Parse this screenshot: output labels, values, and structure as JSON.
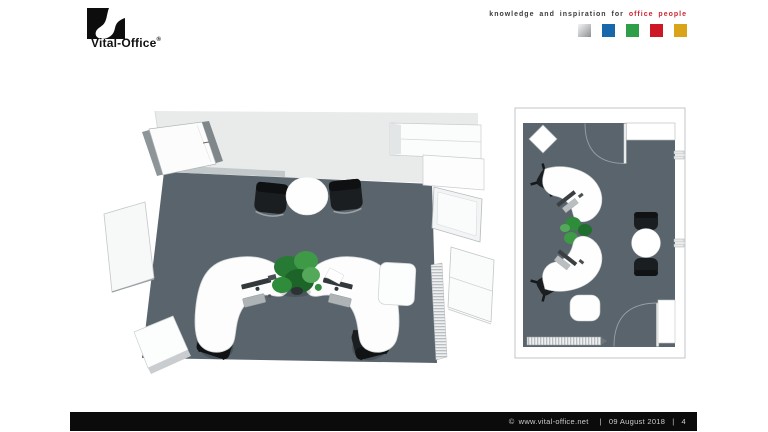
{
  "header": {
    "logo": {
      "text": "Vital-Office",
      "registered_mark": "®"
    },
    "tagline": {
      "prefix": "knowledge and inspiration for",
      "highlight": "office people"
    },
    "brand_squares": [
      {
        "name": "silver",
        "color": "#b5b7b9"
      },
      {
        "name": "blue",
        "color": "#1767ab"
      },
      {
        "name": "green",
        "color": "#2f9e49"
      },
      {
        "name": "red",
        "color": "#cd1626"
      },
      {
        "name": "gold",
        "color": "#d9a417"
      }
    ]
  },
  "content": {
    "perspective_view": {
      "description": "3D bird's-eye rendering of a two-person office",
      "objects": [
        "two curved white workstation desks",
        "two black task chairs",
        "round white meeting table",
        "two black cantilever chairs",
        "green plant",
        "entrance door",
        "wardrobe shelves",
        "wall board",
        "window",
        "radiator",
        "leaning whiteboard",
        "white sideboard cabinets"
      ]
    },
    "floor_plan": {
      "description": "2D top-down floor plan of the same office",
      "objects": [
        "two curved white workstation desks",
        "two black task chairs",
        "round white meeting table",
        "two black visitor chairs",
        "green plant",
        "two door swings",
        "rotated square cabinet",
        "sideboard cabinet",
        "radiator"
      ]
    }
  },
  "footer": {
    "copyright_symbol": "©",
    "website": "www.vital-office.net",
    "separator": "|",
    "date": "09 August 2018",
    "page_number": "4"
  },
  "palette": {
    "floor": "#59646d",
    "ceiling": "#e9ebeb",
    "wall_shade": "#c3c9cb",
    "furniture_white": "#fdfdfe",
    "chair_black": "#1b1e20",
    "plant_green": "#2e8c3a",
    "plant_dark": "#1f6e2d",
    "plant_light": "#54a85a",
    "accent_red": "#cc2631",
    "footer_bg": "#0b0b0b",
    "footer_text": "#cccccc"
  }
}
